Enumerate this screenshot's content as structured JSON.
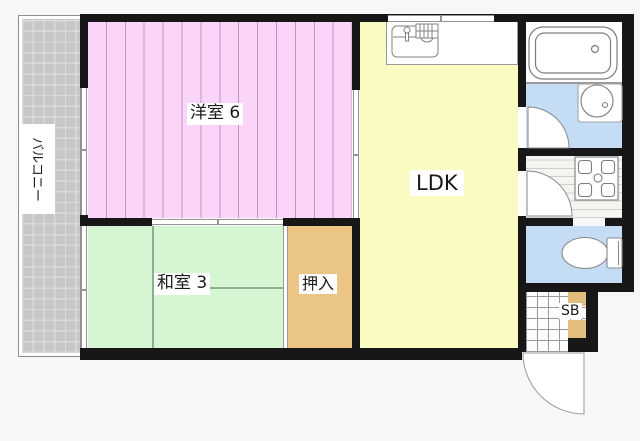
{
  "title": "apartment-floor-plan",
  "rooms": {
    "balcony": {
      "label": "バルコニー",
      "color": "#c7c7c7"
    },
    "western_room": {
      "label": "洋室 6",
      "color": "#fbd5f8"
    },
    "japanese_room": {
      "label": "和室 3",
      "color": "#d6f5d2"
    },
    "closet": {
      "label": "押入",
      "color": "#eac585"
    },
    "ldk": {
      "label": "LDK",
      "color": "#fafac3"
    },
    "shoe_box": {
      "label": "SB",
      "color": "#e2bd7e"
    },
    "bathroom": {
      "color": "#ffffff"
    },
    "washroom": {
      "color": "#c4dcf4"
    },
    "toilet": {
      "color": "#c4dcf4"
    },
    "entrance": {
      "color": "#fdfdfd"
    }
  },
  "fixtures": [
    "bathtub",
    "wash-basin",
    "toilet",
    "kitchen-sink",
    "washing-machine-pan",
    "entrance-door",
    "washroom-door",
    "hallway-door"
  ],
  "colors": {
    "wall": "#171717",
    "line": "#949494",
    "background": "#f7f7f7"
  }
}
